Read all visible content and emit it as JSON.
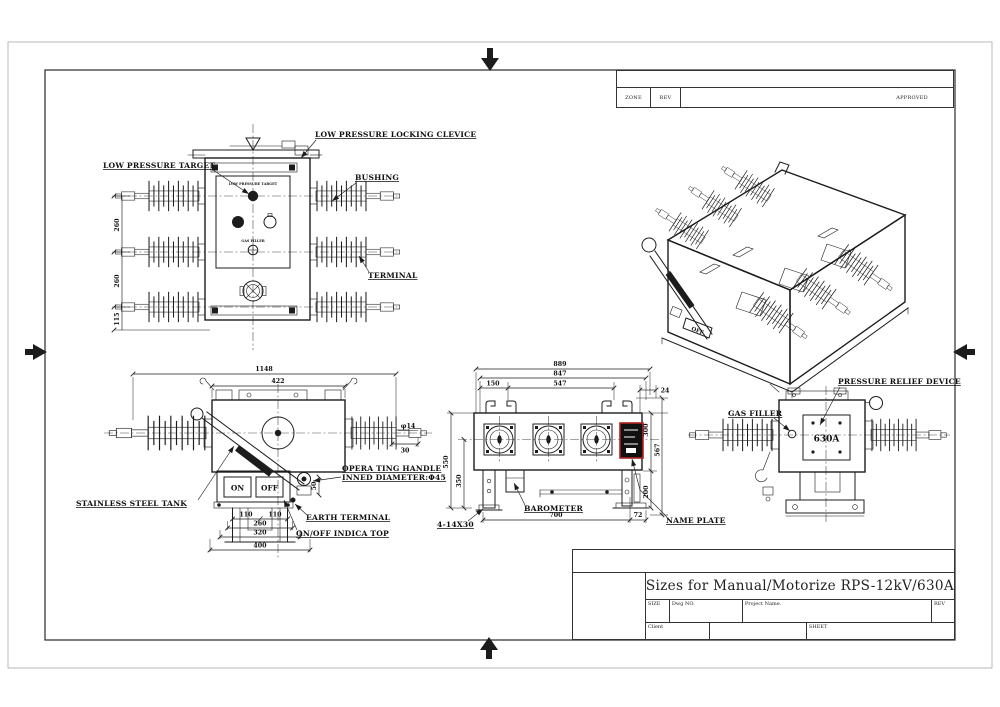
{
  "colors": {
    "line": "#1c1c1c",
    "name_plate_border": "#b22222",
    "name_plate_fill": "#111111",
    "paper_edge": "#b8b8b8"
  },
  "rev_table": {
    "zone_label": "ZONE",
    "rev_label": "REV",
    "approved_label": "APPROVED"
  },
  "title_block": {
    "title": "Sizes for Manual/Motorize RPS-12kV/630A",
    "size_label": "SIZE",
    "dwg_label": "Dwg NO.",
    "project_label": "Project Name.",
    "rev_label": "REV",
    "client_label": "Client",
    "sheet_label": "SHEET"
  },
  "front_view": {
    "callouts": {
      "clevice": "LOW PRESSURE LOCKING CLEVICE",
      "target": "LOW PRESSURE TARGET",
      "bushing": "BUSHING",
      "terminal": "TERMINAL"
    },
    "panel": {
      "title": "LOW PRESSURE TARGET",
      "gas": "GAS FILLER"
    },
    "dims": {
      "v1": "260",
      "v2": "260",
      "v3": "115"
    }
  },
  "handle_view": {
    "callouts": {
      "tank": "STAINLESS STEEL TANK",
      "handle_line1": "OPERA TING HANDLE",
      "handle_line2": "INNED DIAMETER:Φ45",
      "earth": "EARTH TERMINAL",
      "indica": "ON/OFF INDICA TOP"
    },
    "switch": {
      "on": "ON",
      "off": "OFF"
    },
    "dims": {
      "total_width": "1148",
      "tank_width": "422",
      "tip_dia": "φ14",
      "tip_len": "30",
      "socket": "50",
      "b110l": "110",
      "b110r": "110",
      "b260": "260",
      "b320": "320",
      "b400": "400"
    }
  },
  "plan_view": {
    "callouts": {
      "bolts": "4-14X30",
      "barometer": "BAROMETER",
      "name_plate": "NAME PLATE"
    },
    "dims": {
      "t889": "889",
      "t847": "847",
      "t150": "150",
      "t547": "547",
      "t24": "24",
      "l550": "550",
      "l350": "350",
      "r300": "300",
      "r567": "567",
      "r200": "200",
      "b700": "700",
      "b72": "72"
    }
  },
  "gas_view": {
    "callouts": {
      "pressure_relief": "PRESSURE RELIEF DEVICE",
      "gas_filler": "GAS FILLER"
    },
    "rating": "630A"
  },
  "iso_view": {
    "off_label": "OFF"
  }
}
